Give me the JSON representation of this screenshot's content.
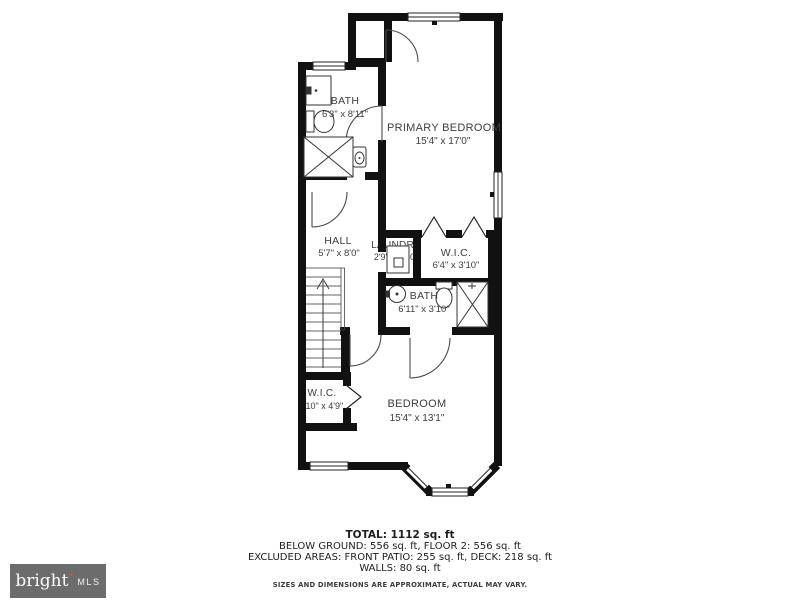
{
  "branding": {
    "brand": "bright",
    "mark": "✶",
    "mls": "MLS"
  },
  "rooms": [
    {
      "id": "bath-upper",
      "name": "BATH",
      "dims": "6'3\" x 8'11\""
    },
    {
      "id": "primary-bedroom",
      "name": "PRIMARY BEDROOM",
      "dims": "15'4\" x 17'0\""
    },
    {
      "id": "hall",
      "name": "HALL",
      "dims": "5'7\" x 8'0\""
    },
    {
      "id": "laundry",
      "name": "LAUNDRY",
      "dims": "2'9\" x 3'10\""
    },
    {
      "id": "wic-middle",
      "name": "W.I.C.",
      "dims": "6'4\" x 3'10\""
    },
    {
      "id": "bath-middle",
      "name": "BATH",
      "dims": "6'11\" x 3'10\""
    },
    {
      "id": "wic-lower",
      "name": "W.I.C.",
      "dims": "3'10\" x 4'9\""
    },
    {
      "id": "bedroom",
      "name": "BEDROOM",
      "dims": "15'4\" x 13'1\""
    }
  ],
  "summary": {
    "total": "TOTAL: 1112 sq. ft",
    "line2": "BELOW GROUND: 556 sq. ft, FLOOR 2: 556 sq. ft",
    "line3": "EXCLUDED AREAS: FRONT PATIO: 255 sq. ft, DECK: 218 sq. ft",
    "line4": "WALLS: 80 sq. ft",
    "disclaimer": "SIZES AND DIMENSIONS ARE APPROXIMATE, ACTUAL MAY VARY."
  }
}
